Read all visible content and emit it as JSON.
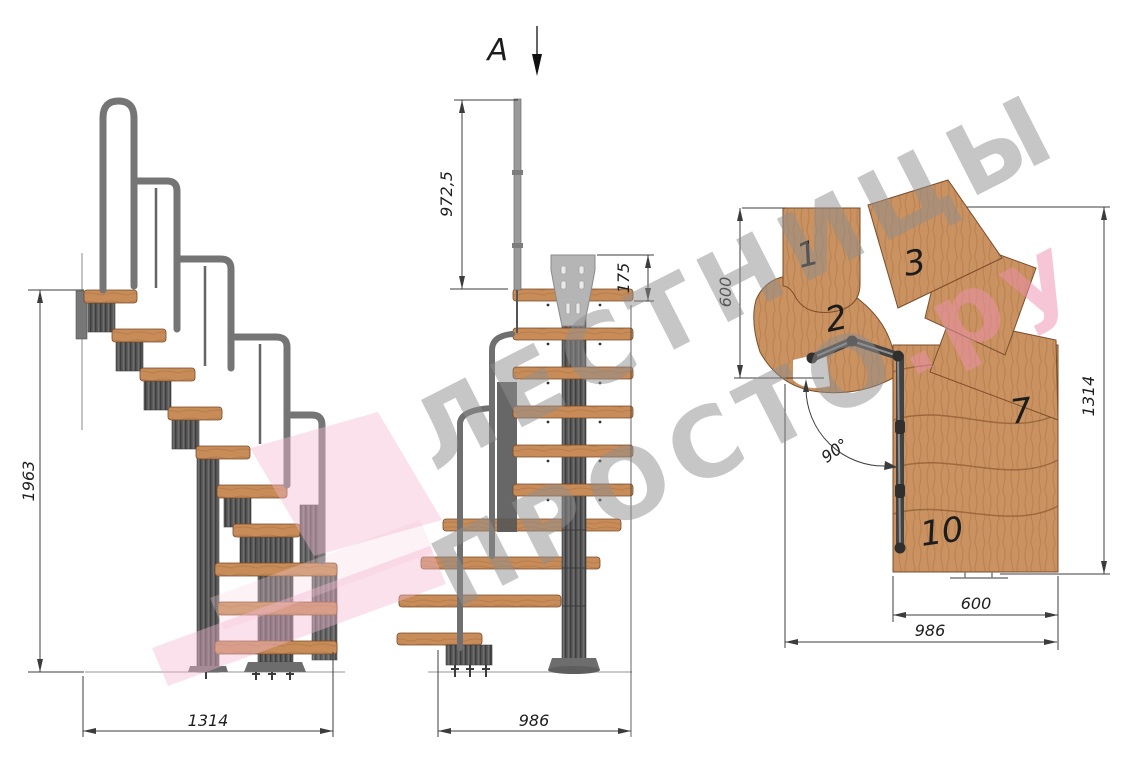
{
  "section_marker": {
    "label": "A"
  },
  "views": {
    "side": {
      "dim_height": "1963",
      "dim_width": "1314"
    },
    "front": {
      "dim_post_height": "972,5",
      "dim_bracket": "175",
      "dim_width": "986"
    },
    "plan": {
      "dim_landing_depth": "600",
      "dim_length": "1314",
      "dim_flight_width": "600",
      "dim_total_width": "986",
      "dim_angle": "90°",
      "steps": [
        "1",
        "2",
        "3",
        "7",
        "10"
      ]
    }
  },
  "watermark": {
    "line1": "ЛЕСТНИЦЫ",
    "line2": "ПРОСТО",
    "suffix": ".ру"
  },
  "colors": {
    "wood": "#c78c58",
    "metal": "#6f6f6f",
    "metal_dark": "#4c4c4c",
    "dimension": "#3c3c3c",
    "watermark_gray": "#8f8f8f",
    "watermark_pink": "#ee8fb0",
    "watermark_arrow_pink": "#f2b8cf"
  }
}
